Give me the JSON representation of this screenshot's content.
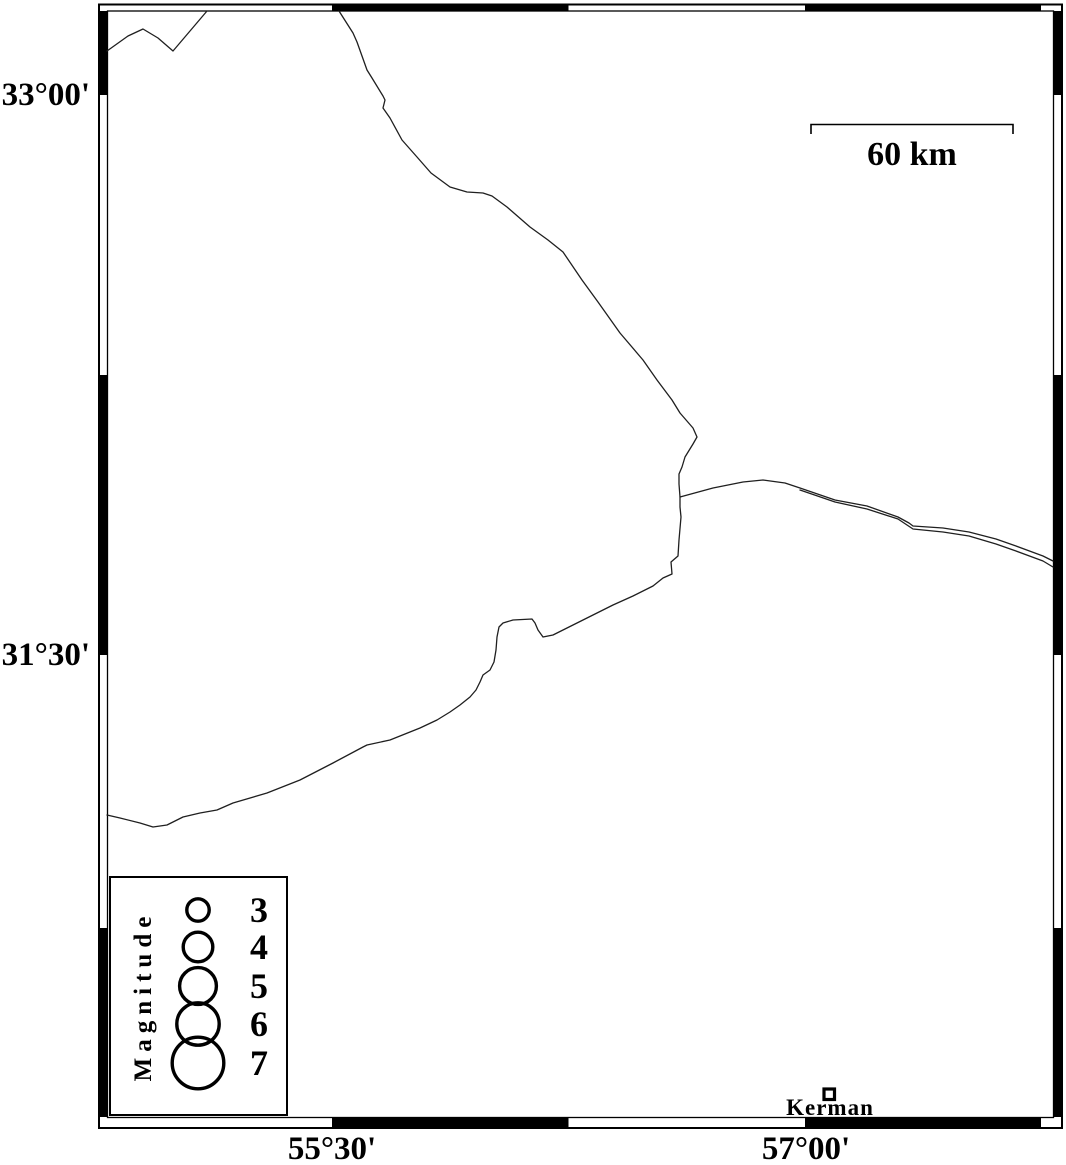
{
  "frame": {
    "lat_labels": [
      {
        "text": "33°00'",
        "y_px": 95
      },
      {
        "text": "31°30'",
        "y_px": 655
      }
    ],
    "lon_labels": [
      {
        "text": "55°30'",
        "x_px": 332
      },
      {
        "text": "57°00'",
        "x_px": 806
      }
    ]
  },
  "scale_bar": {
    "label": "60 km"
  },
  "city": {
    "name": "Kerman"
  },
  "legend": {
    "title": "Magnitude",
    "circle_cx": 198,
    "entries": [
      {
        "label": "3",
        "cy": 910,
        "r": 11.2
      },
      {
        "label": "4",
        "cy": 947,
        "r": 14.8
      },
      {
        "label": "5",
        "cy": 986,
        "r": 18.4
      },
      {
        "label": "6",
        "cy": 1024,
        "r": 21.2
      },
      {
        "label": "7",
        "cy": 1063,
        "r": 25.8
      }
    ]
  },
  "map_lines": {
    "northwest-zigzag": [
      [
        107,
        51
      ],
      [
        128,
        36
      ],
      [
        143,
        29
      ],
      [
        158,
        38
      ],
      [
        173,
        51
      ],
      [
        207,
        11
      ]
    ],
    "main-boundary": [
      [
        339,
        11
      ],
      [
        353,
        33
      ],
      [
        357,
        42
      ],
      [
        367,
        70
      ],
      [
        372,
        78
      ],
      [
        383,
        96
      ],
      [
        385,
        100
      ],
      [
        383,
        108
      ],
      [
        390,
        118
      ],
      [
        402,
        140
      ],
      [
        417,
        157
      ],
      [
        431,
        173
      ],
      [
        450,
        187
      ],
      [
        467,
        192
      ],
      [
        483,
        193
      ],
      [
        492,
        196
      ],
      [
        507,
        207
      ],
      [
        530,
        227
      ],
      [
        548,
        240
      ],
      [
        563,
        252
      ],
      [
        582,
        280
      ],
      [
        598,
        302
      ],
      [
        620,
        333
      ],
      [
        643,
        360
      ],
      [
        657,
        380
      ],
      [
        672,
        400
      ],
      [
        680,
        413
      ],
      [
        693,
        428
      ],
      [
        697,
        437
      ],
      [
        693,
        444
      ],
      [
        685,
        457
      ],
      [
        682,
        467
      ],
      [
        679,
        474
      ],
      [
        679,
        484
      ],
      [
        680,
        497
      ],
      [
        680,
        507
      ],
      [
        681,
        517
      ],
      [
        679,
        540
      ],
      [
        678,
        556
      ],
      [
        671,
        562
      ],
      [
        672,
        574
      ],
      [
        663,
        578
      ],
      [
        653,
        586
      ],
      [
        633,
        596
      ],
      [
        613,
        605
      ],
      [
        593,
        615
      ],
      [
        573,
        625
      ],
      [
        553,
        635
      ],
      [
        543,
        637
      ],
      [
        538,
        630
      ],
      [
        535,
        623
      ],
      [
        532,
        619
      ],
      [
        513,
        620
      ],
      [
        503,
        623
      ],
      [
        499,
        627
      ],
      [
        497,
        637
      ],
      [
        496,
        650
      ],
      [
        494,
        662
      ],
      [
        490,
        670
      ],
      [
        483,
        675
      ],
      [
        480,
        682
      ],
      [
        476,
        690
      ],
      [
        470,
        697
      ],
      [
        460,
        705
      ],
      [
        450,
        712
      ],
      [
        437,
        720
      ],
      [
        420,
        728
      ],
      [
        410,
        732
      ],
      [
        390,
        740
      ],
      [
        367,
        745
      ],
      [
        363,
        747
      ],
      [
        333,
        763
      ],
      [
        300,
        780
      ],
      [
        267,
        793
      ],
      [
        233,
        803
      ],
      [
        217,
        810
      ],
      [
        200,
        813
      ],
      [
        183,
        817
      ],
      [
        167,
        825
      ],
      [
        153,
        827
      ],
      [
        140,
        823
      ],
      [
        120,
        818
      ],
      [
        107,
        815
      ]
    ],
    "east-boundary-north": [
      [
        680,
        497
      ],
      [
        713,
        488
      ],
      [
        743,
        482
      ],
      [
        763,
        480
      ],
      [
        785,
        483
      ],
      [
        800,
        488
      ],
      [
        835,
        500
      ],
      [
        867,
        506
      ],
      [
        898,
        517
      ],
      [
        909,
        523
      ],
      [
        913,
        526
      ],
      [
        943,
        528
      ],
      [
        969,
        532
      ],
      [
        996,
        539
      ],
      [
        1016,
        546
      ],
      [
        1043,
        556
      ],
      [
        1053,
        561
      ]
    ],
    "east-boundary-south": [
      [
        800,
        490
      ],
      [
        835,
        502
      ],
      [
        867,
        509
      ],
      [
        898,
        519
      ],
      [
        913,
        529
      ],
      [
        943,
        532
      ],
      [
        969,
        536
      ],
      [
        996,
        544
      ],
      [
        1016,
        551
      ],
      [
        1043,
        561
      ],
      [
        1053,
        567
      ]
    ]
  }
}
